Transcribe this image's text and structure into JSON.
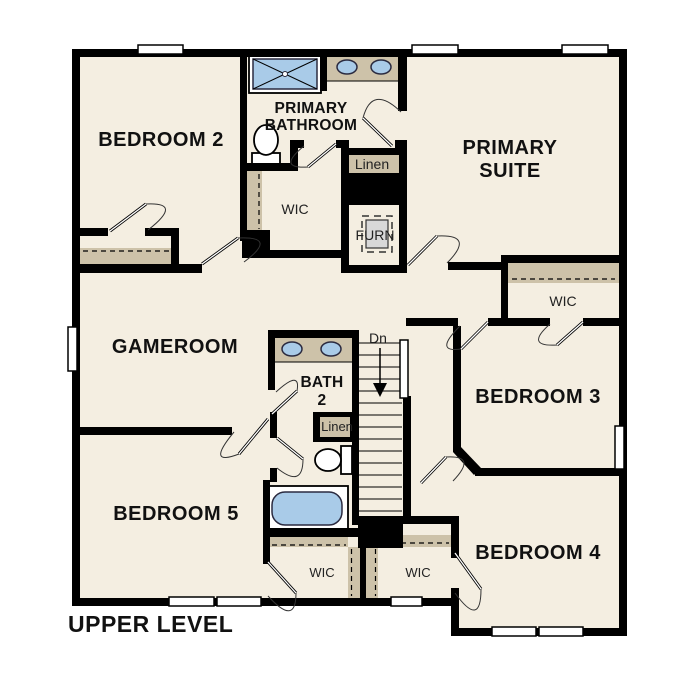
{
  "plan": {
    "title": "UPPER LEVEL"
  },
  "labels": {
    "bedroom2": "BEDROOM 2",
    "primary_bathroom": {
      "line1": "PRIMARY",
      "line2": "BATHROOM"
    },
    "primary_suite": {
      "line1": "PRIMARY",
      "line2": "SUITE"
    },
    "gameroom": "GAMEROOM",
    "bath2": {
      "line1": "BATH",
      "line2": "2"
    },
    "bedroom3": "BEDROOM 3",
    "bedroom4": "BEDROOM 4",
    "bedroom5": "BEDROOM 5",
    "wic_primary": "WIC",
    "wic_bedroom3": "WIC",
    "wic_bedroom5": "WIC",
    "wic_bedroom4": "WIC",
    "linen_primary": "Linen",
    "linen_bath2": "Linen",
    "furnace": "FURN",
    "stairs_down": "Dn"
  },
  "colors": {
    "bg": "#ffffff",
    "floor": "#f4eee1",
    "wall": "#000000",
    "shelf": "#cdc2a9",
    "fixture_blue": "#a9cbe8",
    "fixture_stroke": "#2b2b40",
    "furnace_gray": "#d8d8d8"
  }
}
